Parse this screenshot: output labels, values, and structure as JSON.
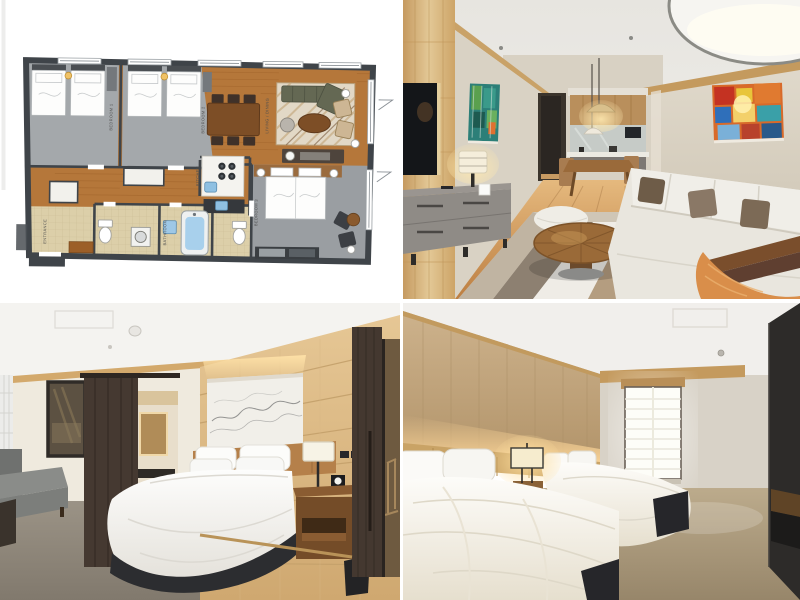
{
  "page": {
    "background": "#ffffff",
    "name": "hotel-suite-photo-grid"
  },
  "grid": {
    "gap_color": "#ffffff",
    "tiles": [
      {
        "name": "floor-plan",
        "kind": "plan-image"
      },
      {
        "name": "living-room",
        "kind": "photo"
      },
      {
        "name": "king-bedroom",
        "kind": "photo"
      },
      {
        "name": "twin-bedroom",
        "kind": "photo"
      }
    ]
  },
  "floor_plan": {
    "labels": {
      "bedroom1": "BEDROOM 1",
      "bedroom2": "BEDROOM 2",
      "bedroom3": "BEDROOM 3",
      "living": "LIVING / DINING",
      "kitchen": "KITCHEN",
      "bathroom": "BATHROOM",
      "entrance": "ENTRANCE"
    }
  },
  "palette": {
    "page-bg": "#ffffff",
    "plan-wall": "#3f4449",
    "plan-carpet": "#a4a8ab",
    "plan-carpet-dark": "#9a9ea2",
    "plan-wood": "#b5773a",
    "plan-wood-line": "#9d6128",
    "plan-tile": "#dccfa9",
    "plan-rug": "#e2d8c6",
    "plan-sofa": "#646853",
    "plan-table": "#7d4e26",
    "plan-sink": "#8fc0e2",
    "plan-water": "#a8d0ec",
    "plan-mat": "#9c5f28",
    "plan-label": "#4f4f4f",
    "photo-ceiling": "#efeeea",
    "photo-greige-wall": "#d8d1c3",
    "photo-wood": "#cfa368",
    "photo-sofa-white": "#eae7df",
    "photo-throw-orange": "#d98e4a",
    "photo-carpet-gray": "#948c80",
    "photo-carpet-tan": "#b3a383",
    "photo-dark-door": "#453931",
    "photo-bed-base": "#2a2b2e"
  }
}
